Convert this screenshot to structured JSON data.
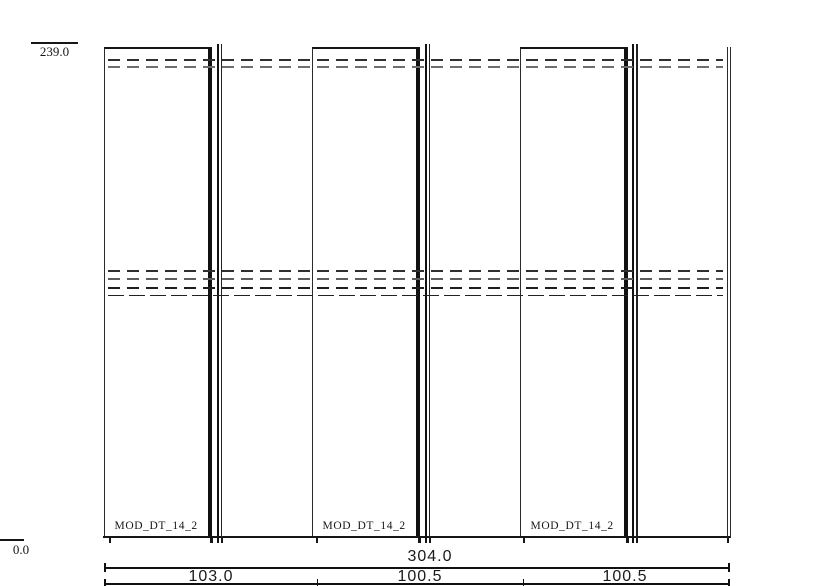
{
  "levels": {
    "top": "239.0",
    "bottom": "0.0"
  },
  "modules": [
    {
      "label": "MOD_DT_14_2"
    },
    {
      "label": "MOD_DT_14_2"
    },
    {
      "label": "MOD_DT_14_2"
    }
  ],
  "dimensions": {
    "overall": "304.0",
    "segments": [
      "103.0",
      "100.5",
      "100.5"
    ]
  },
  "colors": {
    "line": "#161616",
    "hidden_rail": "#6e6e6e",
    "background": "#ffffff"
  }
}
